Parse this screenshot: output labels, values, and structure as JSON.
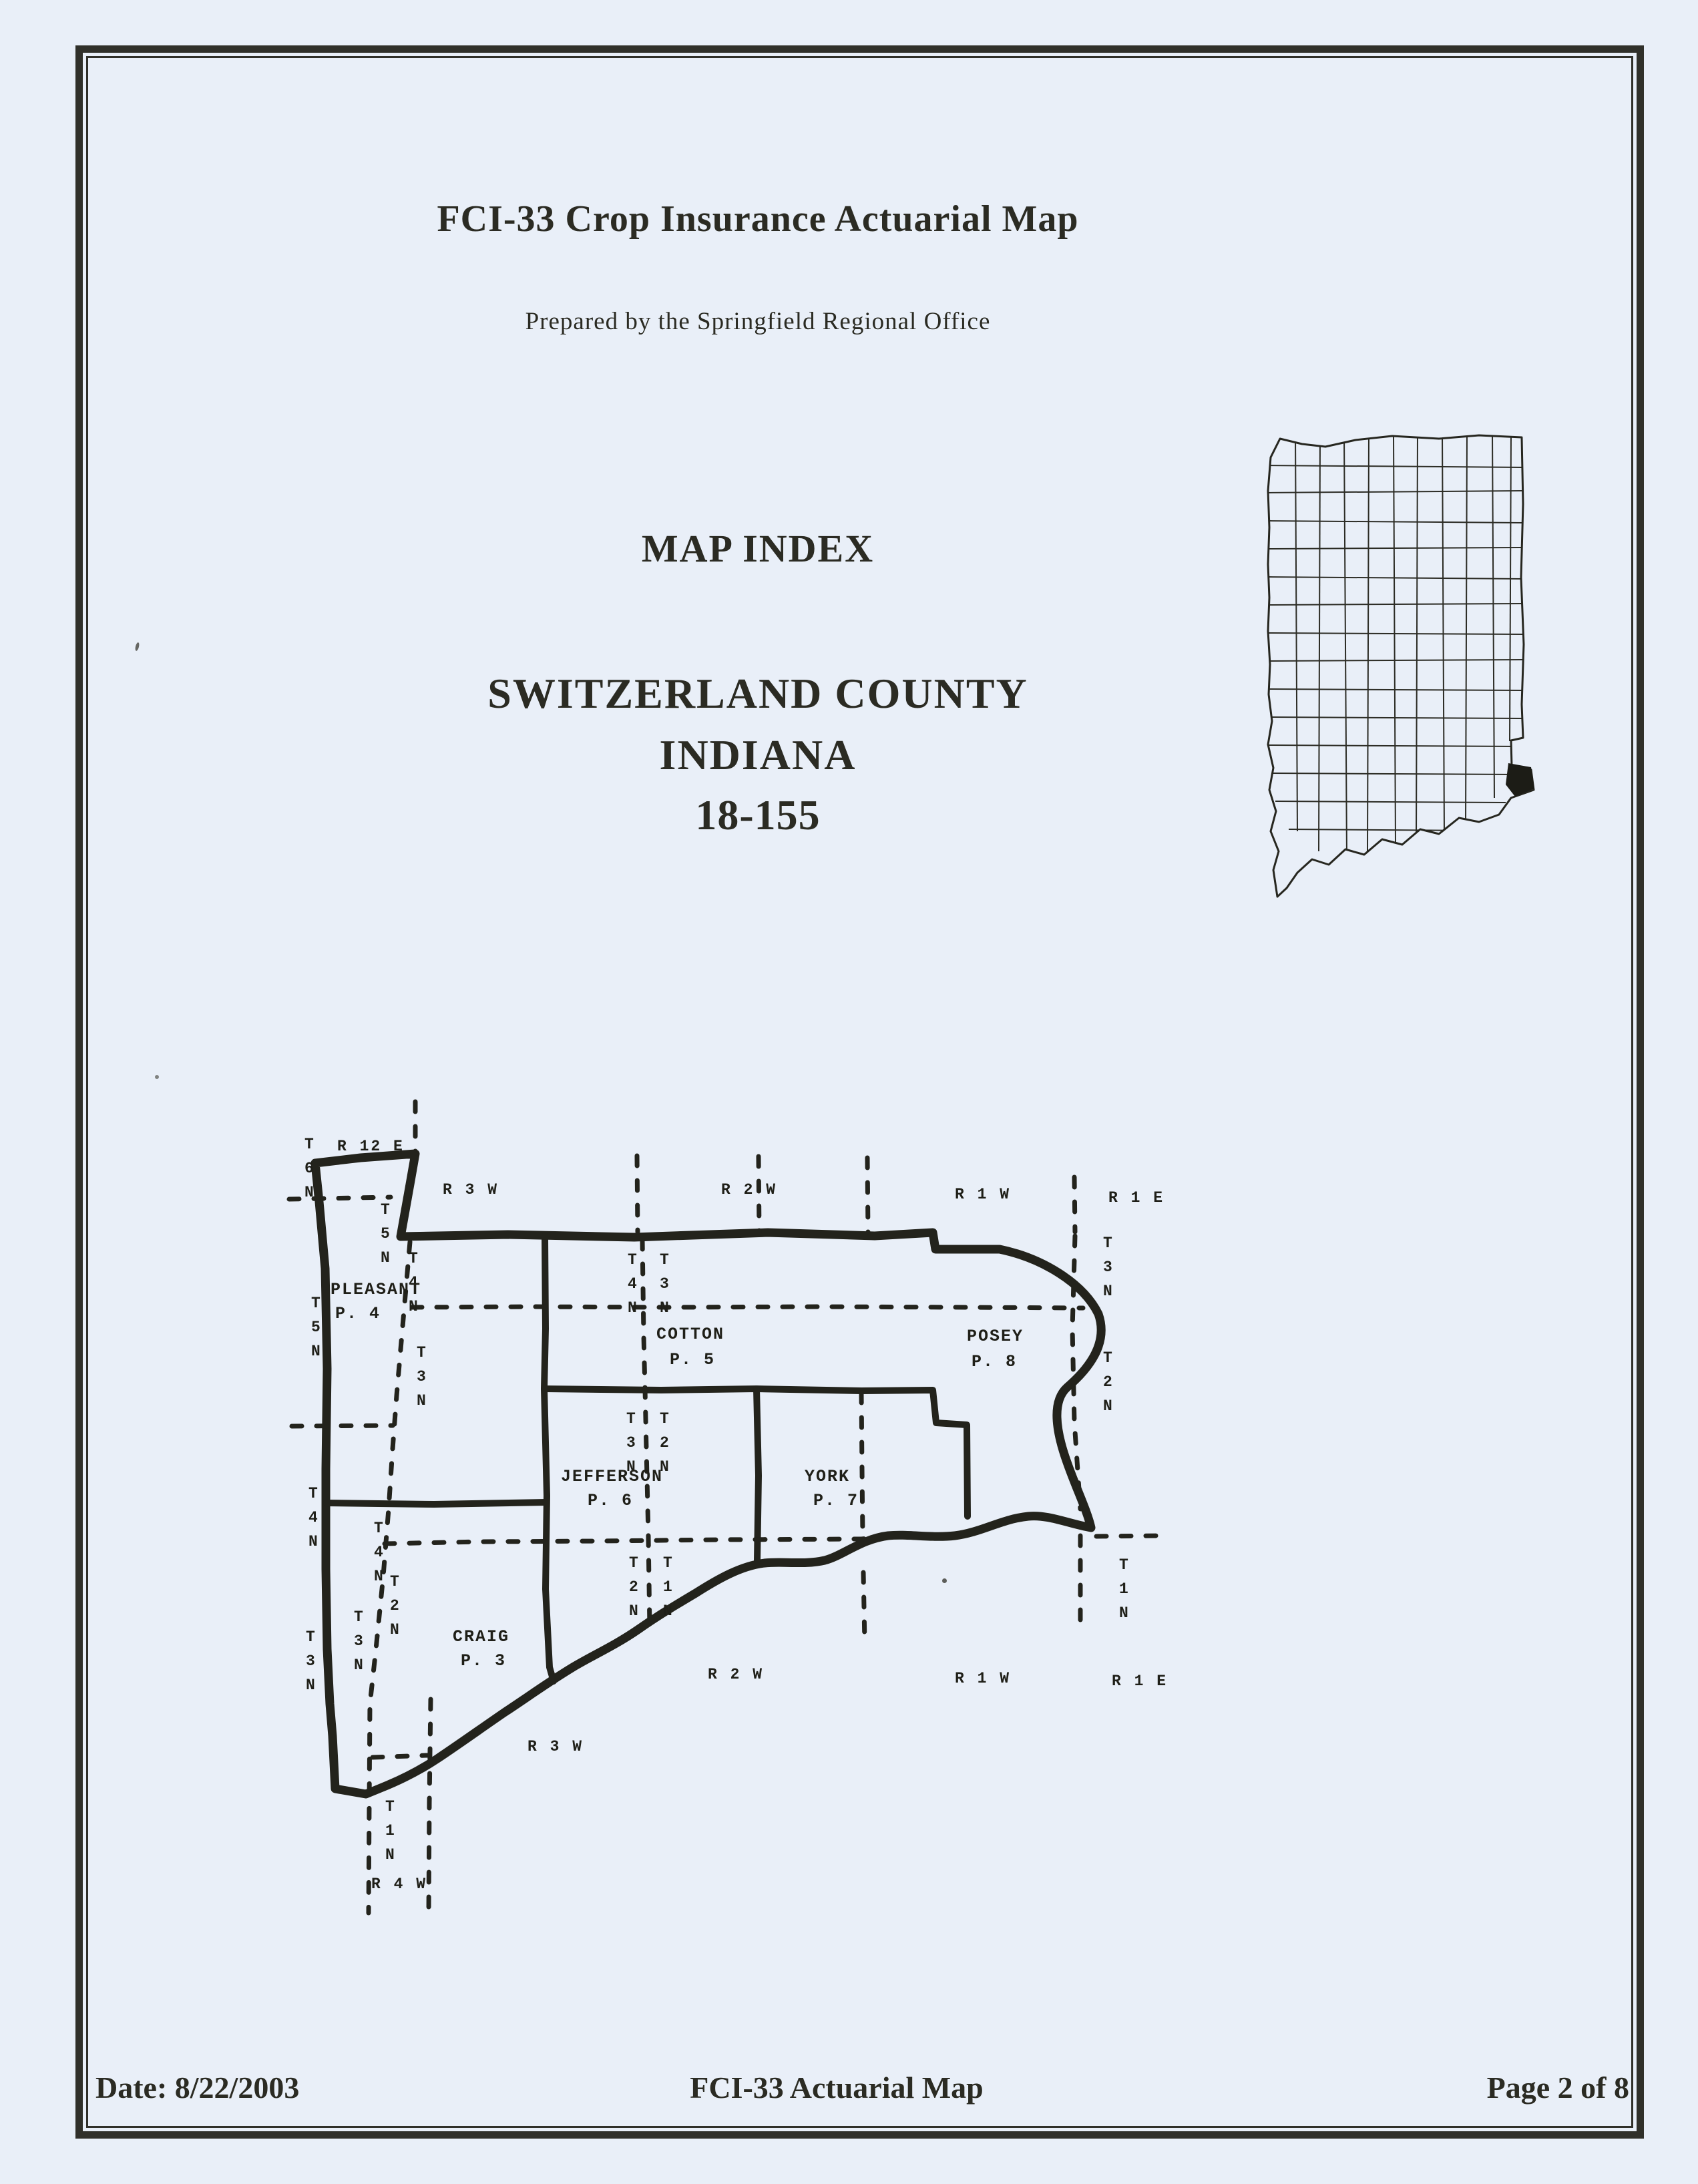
{
  "page": {
    "background": "#e9eff8",
    "ink": "#2b2b23"
  },
  "header": {
    "title": "FCI-33 Crop Insurance Actuarial Map",
    "subtitle": "Prepared by the Springfield Regional Office",
    "map_index": "MAP INDEX",
    "county_line1": "SWITZERLAND COUNTY",
    "county_line2": "INDIANA",
    "county_code": "18-155"
  },
  "footer": {
    "date": "Date: 8/22/2003",
    "title": "FCI-33 Actuarial Map",
    "page": "Page 2 of 8"
  },
  "inset": {
    "highlight_color": "#1c1c16"
  },
  "county_map": {
    "townships": {
      "pleasant": {
        "name": "PLEASANT",
        "page": "P. 4"
      },
      "cotton": {
        "name": "COTTON",
        "page": "P. 5"
      },
      "posey": {
        "name": "POSEY",
        "page": "P. 8"
      },
      "jefferson": {
        "name": "JEFFERSON",
        "page": "P. 6"
      },
      "york": {
        "name": "YORK",
        "page": "P. 7"
      },
      "craig": {
        "name": "CRAIG",
        "page": "P. 3"
      }
    },
    "range_labels": {
      "top_r12e": "R 12 E",
      "top_r3w": "R 3 W",
      "top_r2w": "R 2 W",
      "top_r1w": "R 1 W",
      "top_r1e": "R 1 E",
      "bottom_r4w": "R 4 W",
      "bottom_r3w": "R 3 W",
      "bottom_r2w": "R 2 W",
      "bottom_r1w": "R 1 W",
      "bottom_r1e": "R 1 E"
    },
    "township_labels": {
      "left_t6n": "T6N",
      "left_t5n": "T5N",
      "left_t4n": "T4N",
      "left_t3n": "T3N",
      "diag_t5n": "T5N",
      "diag_t4n": "T4N",
      "diag_t3n": "T3N",
      "diag2_t4n": "T4N",
      "diag2_t2n": "T2N",
      "diag2_t3n": "T3N",
      "tip_t1n": "T1N",
      "pair1_t4n": "T4N",
      "pair1_t3n": "T3N",
      "pair2_t3n": "T3N",
      "pair2_t2n": "T2N",
      "pair3_t2n": "T2N",
      "pair3_t1n": "T1N",
      "right_t3n": "T3N",
      "right_t2n": "T2N",
      "se_t1n": "T1N"
    }
  }
}
